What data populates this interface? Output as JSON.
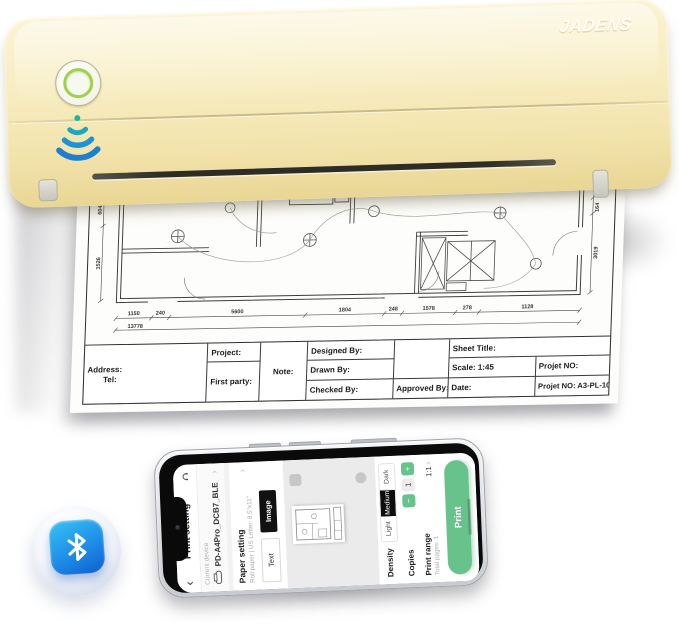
{
  "printer": {
    "brand": "JADENS"
  },
  "document": {
    "table": {
      "address": "Address:",
      "tel": "Tel:",
      "project": "Project:",
      "first_party": "First party:",
      "note": "Note:",
      "designed_by": "Designed By:",
      "drawn_by": "Drawn By:",
      "checked_by": "Checked By:",
      "approved_by": "Approved By:",
      "sheet_title": "Sheet Title:",
      "scale": "Scale: 1:45",
      "date": "Date:",
      "projet_no": "Projet NO:",
      "projet_no_value": "Projet NO: A3-PL-10"
    },
    "dims_bottom": [
      "1150",
      "240",
      "5600",
      "1804",
      "248",
      "1578",
      "278",
      "1128"
    ],
    "dims_total": "13778",
    "dims_left": [
      "604",
      "1526"
    ],
    "dims_right": [
      "150",
      "164",
      "3019"
    ]
  },
  "phone": {
    "header": {
      "back": "‹",
      "title": "Print setting"
    },
    "device": {
      "label": "Current device",
      "name": "PD-A4Pro_DCB7_BLE",
      "chevron": "›"
    },
    "paper": {
      "label": "Paper setting",
      "value": "Roll paper | US Letter: 8.5\"x11\"",
      "chevron": "›"
    },
    "mode": {
      "text": "Text",
      "image": "Image"
    },
    "density": {
      "label": "Density",
      "light": "Light",
      "medium": "Medium",
      "dark": "Dark"
    },
    "copies": {
      "label": "Copies",
      "minus": "−",
      "value": "1",
      "plus": "+"
    },
    "range": {
      "label": "Print range",
      "sub": "Total pages: 1",
      "value": "1:1",
      "chevron": "›"
    },
    "print": "Print"
  },
  "colors": {
    "printer_body": "#f5e9b8",
    "power_ring": "#a2cf4c",
    "accent_green": "#67c28b",
    "bluetooth_blue": "#1e8ee8"
  }
}
